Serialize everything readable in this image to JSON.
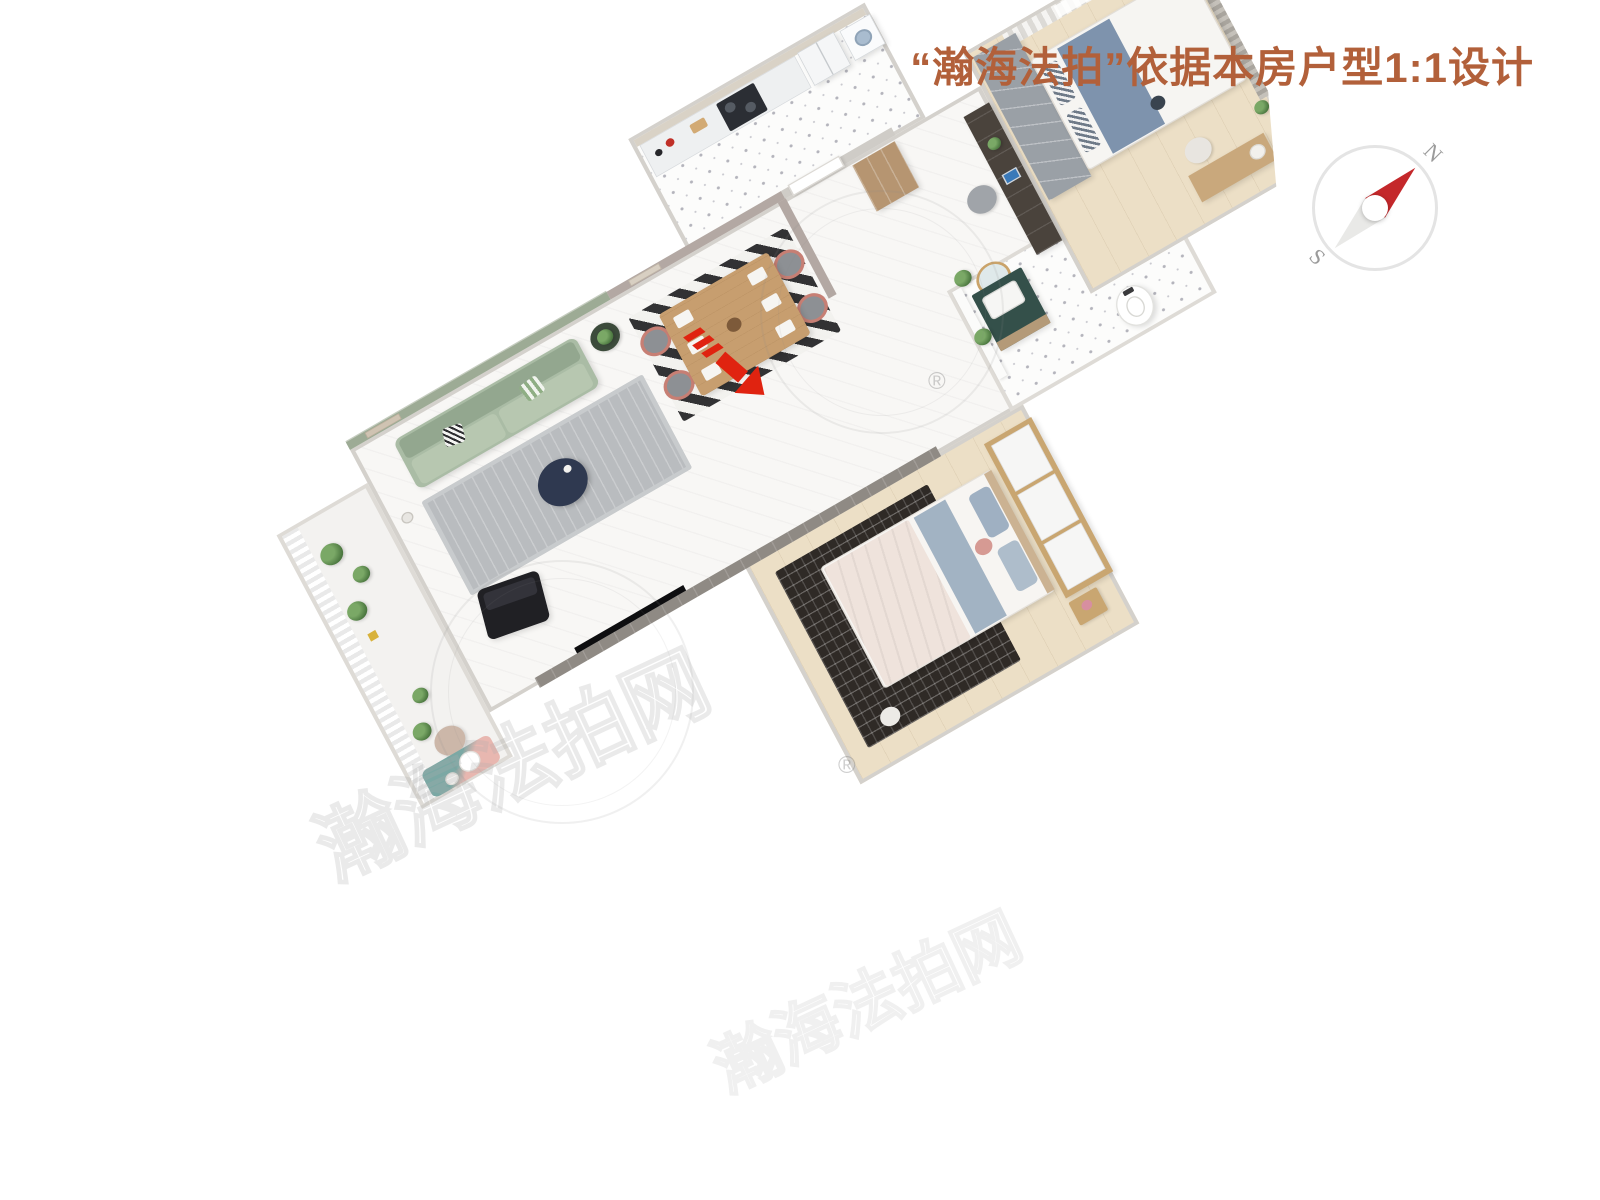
{
  "header": {
    "title": "“瀚海法拍”依据本房户型1:1设计",
    "title_color": "#b2603a"
  },
  "compass": {
    "north_label": "N",
    "south_label": "S",
    "ring_color": "#e4e4e4",
    "needle_north_color": "#c4282b",
    "needle_south_color": "#e9e9e7"
  },
  "entrance_marker": {
    "color": "#e02310"
  },
  "watermarks": {
    "site_text": "瀚海法拍网",
    "site_text_2": "瀚海法拍网",
    "registered_symbol": "®",
    "registered_symbol_2": "®"
  },
  "palette": {
    "living_accent_wall": "#9dab95",
    "dining_wall": "#b3a8a3",
    "sofa": "#aabca5",
    "living_rug": "#b9bcbf",
    "coffee_table": "#2f3950",
    "dining_table": "#c79e6f",
    "kitchen_cabinet": "#eef0f1",
    "stove": "#2b2e34",
    "tv_wall": "#8f8a84",
    "master_rug": "#2f2a26",
    "wardrobe_wood": "#c9a671",
    "bedroom2_wardrobe": "#9aa0a6",
    "vanity_top": "#34504a",
    "marble_floor": "#f8f7f5",
    "wood_floor": "#ecdfc6"
  }
}
